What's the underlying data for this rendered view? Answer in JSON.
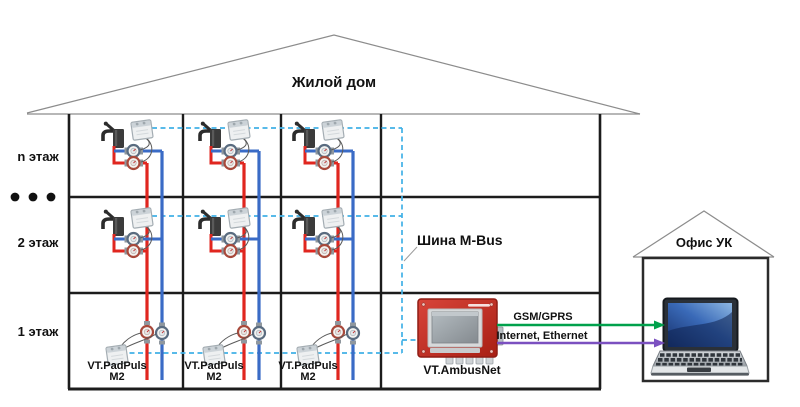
{
  "diagram": {
    "building": {
      "title": "Жилой дом",
      "floor_labels": [
        "n этаж",
        "2 этаж",
        "1 этаж"
      ],
      "bus_label": "Шина M-Bus",
      "meter_units": [
        {
          "name": "VT.PadPuls",
          "model": "M2"
        },
        {
          "name": "VT.PadPuls",
          "model": "M2"
        },
        {
          "name": "VT.PadPuls",
          "model": "M2"
        }
      ]
    },
    "gateway": {
      "label": "VT.AmbusNet"
    },
    "links": [
      {
        "label": "GSM/GPRS",
        "color": "#00A14C"
      },
      {
        "label": "Internet, Ethernet",
        "color": "#7B50C0"
      }
    ],
    "office": {
      "label": "Офис УК"
    },
    "colors": {
      "hot_pipe": "#E0261F",
      "cold_pipe": "#3A6BC6",
      "mbus_line": "#41B1E6",
      "gateway_body": "#C1272D"
    },
    "icons": [
      "faucet-icon",
      "water-meter-hot-icon",
      "water-meter-cold-icon",
      "pulse-adapter-icon",
      "gateway-device-icon",
      "laptop-icon",
      "ellipsis-dots-icon"
    ]
  }
}
